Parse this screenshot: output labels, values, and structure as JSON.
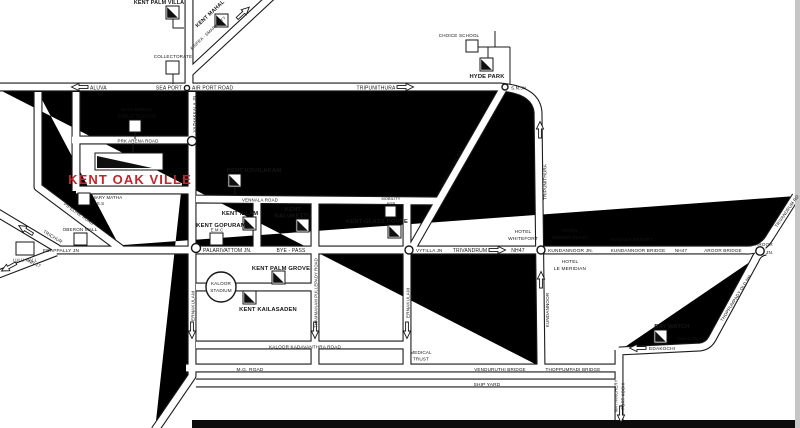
{
  "map": {
    "name": "Kent Oak Ville location map",
    "highlight_color": "#c0272d",
    "labels": {
      "kent_palm_villa": "KENT PALM VILLA",
      "kent_mahal": "KENT MAHAL",
      "kinfra": "KINFRA - SMART CITY",
      "collectorate": "COLLECTORATE",
      "aluva": "ALUVA",
      "sea_port": "SEA PORT",
      "air_port_road": "AIR PORT ROAD",
      "tripunithura": "TRIPUNITHURA",
      "sn_jn": "S.N.JN",
      "choice_school": "CHOICE SCHOOL",
      "hyde_park": "HYDE PARK",
      "vazhakkala_jn": "VAZHAKKALA JN",
      "prk_arena_road": "PRK ARENA ROAD",
      "nava_nirmal_1": "NAVA NIRMAL",
      "nava_nirmal_2": "PUBLIC SCHOOL",
      "kent_oak_ville": "KENT OAK VILLE",
      "mary_matha_1": "MARY MATHA",
      "mary_matha_2": "H.S.S",
      "pipeline_road": "PIPELINE ROAD",
      "oberon_mall": "OBERON MALL",
      "edappally_jn": "EDAPPALLY JN",
      "trichur": "TRICHUR",
      "lulu_mall": "LULU MALL",
      "nh17": "NH-17",
      "vennala_road": "VENNALA ROAD",
      "kent_kovilakam": "KENT KOVILAKAM",
      "mobility_1": "MOBILITY",
      "mobility_2": "HUB",
      "kent_illam": "KENT ILLAM",
      "kent_gopuram": "KENT GOPURAM",
      "emc": "E.M.C",
      "kent_nalukettu_1": "KENT",
      "kent_nalukettu_2": "NALUKETTU",
      "kent_glass_house": "KENT GLASS HOUSE",
      "palarivattom_jn": "PALARIVATTOM JN.",
      "bye_pass": "BYE - PASS",
      "vytilla_jn": "VYTILLA JN",
      "tripunithura_rd": "TRIPUNITHURA RD",
      "trivandrum": "TRIVANDRUM",
      "nh47": "NH47",
      "hotel_whitefort_1": "HOTEL",
      "hotel_whitefort_2": "WHITEFORT",
      "hotel_crown_1": "HOTEL",
      "hotel_crown_2": "CROWN PLAZA",
      "kundannoor_jn": "KUNDANNOOR JN.",
      "ramada_resort": "RAMADA RESORT",
      "kundannoor_bridge": "KUNDANNOOR BRIDGE",
      "nh47_b": "NH47",
      "aroor_bridge": "AROOR BRIDGE",
      "aroor_1": "AROOR",
      "aroor_2": "JN.",
      "trivandrum_rd": "TRIVANDRUM RD",
      "hotel_meridian_1": "HOTEL",
      "hotel_meridian_2": "LE MERIDIAN",
      "tripunithura_v": "TRIPUNITHURA",
      "kundannoor_v": "KUNDANNOOR",
      "kaloor_1": "KALOOR",
      "kaloor_2": "STADIUM",
      "ernakulam_w": "ERNAKULAM",
      "kent_palm_grove": "KENT PALM GROVE",
      "kent_kailasaden": "KENT KAILASADEN",
      "thammanam": "THAMMANAM PULLEPADY ROAD",
      "ernakulam_e": "ERNAKULAM",
      "kkr_road": "KALOOR KADAVANTHRA ROAD",
      "medical_1": "MEDICAL",
      "medical_2": "TRUST",
      "mg_road": "M.G. ROAD",
      "venduruthi_bridge": "VENDURUTHI BRIDGE",
      "thoppumpadi_bridge": "THOPPUMPADI BRIDGE",
      "ship_yard": "SHIP YARD",
      "bay_watch": "BAY WATCH",
      "chacolas": "CHACOLAS",
      "edakochi": "EDAKOCHI",
      "thoppumpady_old_nh": "THOPPUMPADY OLD NH",
      "mattanchery_1": "MATTANCHERY",
      "mattanchery_2": "FORT KOCHI"
    }
  }
}
